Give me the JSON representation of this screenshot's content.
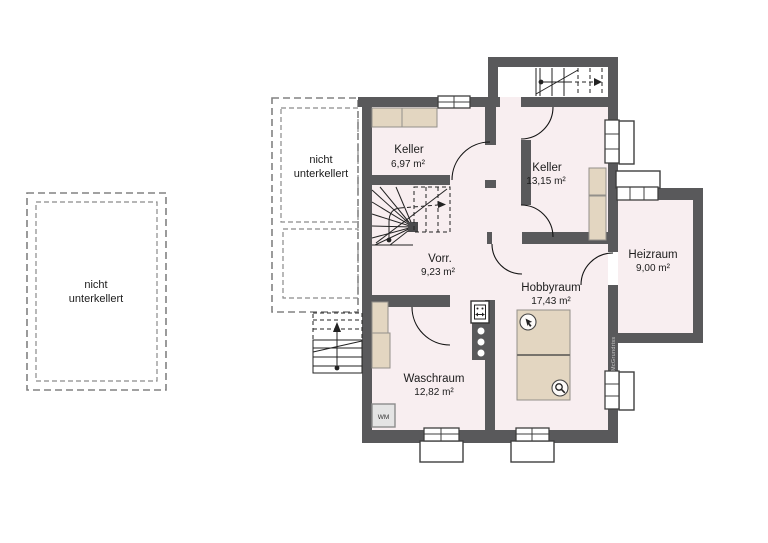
{
  "rooms": [
    {
      "id": "keller-1",
      "name": "Keller",
      "area": "6,97 m²"
    },
    {
      "id": "keller-2",
      "name": "Keller",
      "area": "13,15 m²"
    },
    {
      "id": "vorraum",
      "name": "Vorr.",
      "area": "9,23 m²"
    },
    {
      "id": "hobbyraum",
      "name": "Hobbyraum",
      "area": "17,43 m²"
    },
    {
      "id": "waschraum",
      "name": "Waschraum",
      "area": "12,82 m²"
    },
    {
      "id": "heizraum",
      "name": "Heizraum",
      "area": "9,00 m²"
    }
  ],
  "annotations": {
    "no_basement_line1": "nicht",
    "no_basement_line2": "unterkellert",
    "washing_machine": "WM",
    "watermark": "McGrundriss"
  },
  "icons": {
    "hand_pointer": "hand-pointer-icon",
    "magnifier": "magnifier-icon"
  },
  "colors": {
    "wall": "#59595b",
    "floor": "#f8eef0",
    "furniture": "#e3d6c1",
    "stair_line": "#222222",
    "dashed_outline": "#828282",
    "lightwell_border": "#3f3f3f"
  }
}
